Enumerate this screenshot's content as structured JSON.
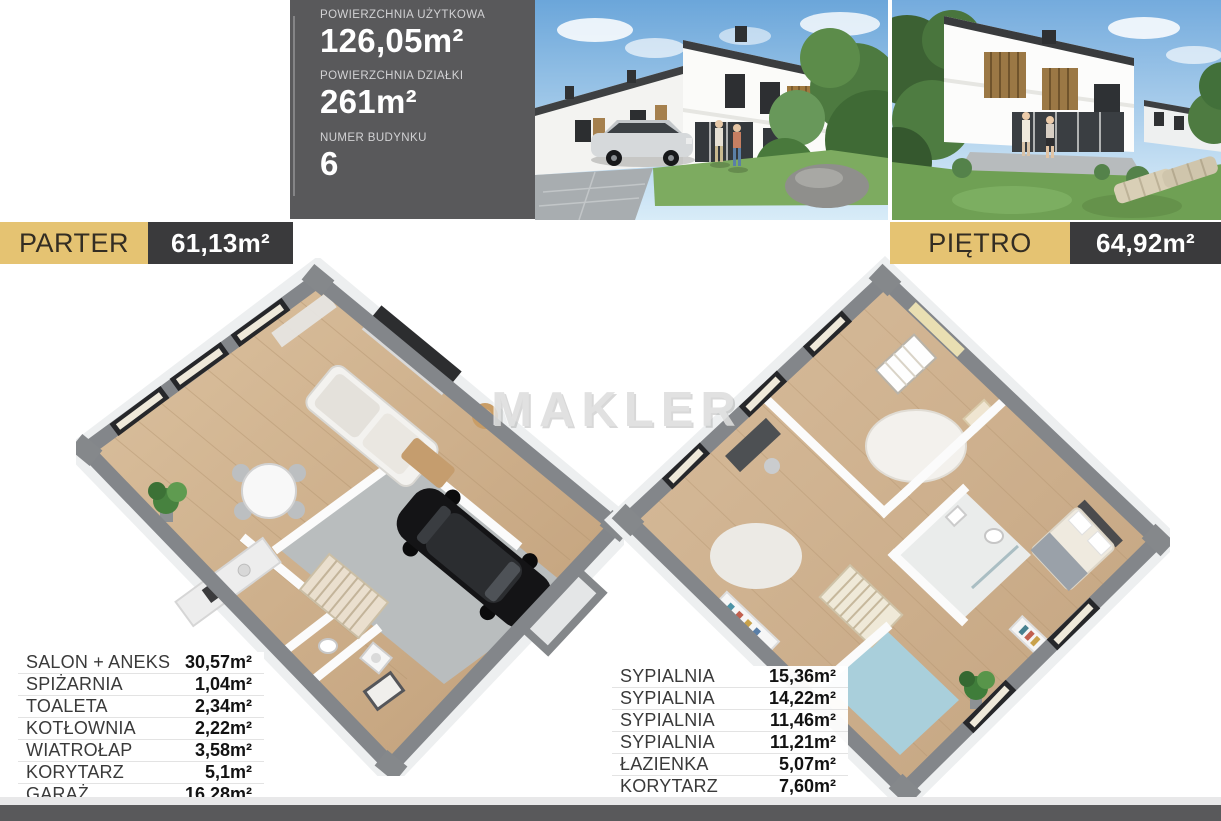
{
  "info_panel": {
    "items": [
      {
        "label": "POWIERZCHNIA UŻYTKOWA",
        "value": "126,05m²"
      },
      {
        "label": "POWIERZCHNIA DZIAŁKI",
        "value": "261m²"
      },
      {
        "label": "NUMER BUDYNKU",
        "value": "6"
      }
    ]
  },
  "banners": {
    "parter": {
      "title": "PARTER",
      "area": "61,13m²"
    },
    "pietro": {
      "title": "PIĘTRO",
      "area": "64,92m²"
    }
  },
  "watermark": {
    "text": "MAKLER"
  },
  "room_lists": {
    "parter": {
      "rows": [
        {
          "name": "SALON + ANEKS",
          "area": "30,57m²"
        },
        {
          "name": "SPIŻARNIA",
          "area": "1,04m²"
        },
        {
          "name": "TOALETA",
          "area": "2,34m²"
        },
        {
          "name": "KOTŁOWNIA",
          "area": "2,22m²"
        },
        {
          "name": "WIATROŁAP",
          "area": "3,58m²"
        },
        {
          "name": "KORYTARZ",
          "area": "5,1m²"
        },
        {
          "name": "GARAŻ",
          "area": "16,28m²"
        }
      ]
    },
    "pietro": {
      "rows": [
        {
          "name": "SYPIALNIA",
          "area": "15,36m²"
        },
        {
          "name": "SYPIALNIA",
          "area": "14,22m²"
        },
        {
          "name": "SYPIALNIA",
          "area": "11,46m²"
        },
        {
          "name": "SYPIALNIA",
          "area": "11,21m²"
        },
        {
          "name": "ŁAZIENKA",
          "area": "5,07m²"
        },
        {
          "name": "KORYTARZ",
          "area": "7,60m²"
        }
      ]
    }
  },
  "photos": {
    "street": {
      "name": "osiedle-street-view-photo"
    },
    "garden": {
      "name": "garden-terrace-view-photo"
    }
  },
  "colors": {
    "accent_gold": "#e5c372",
    "panel_gray": "#59595b",
    "banner_dark": "#3a3a3c",
    "footer_gray": "#59595b"
  }
}
